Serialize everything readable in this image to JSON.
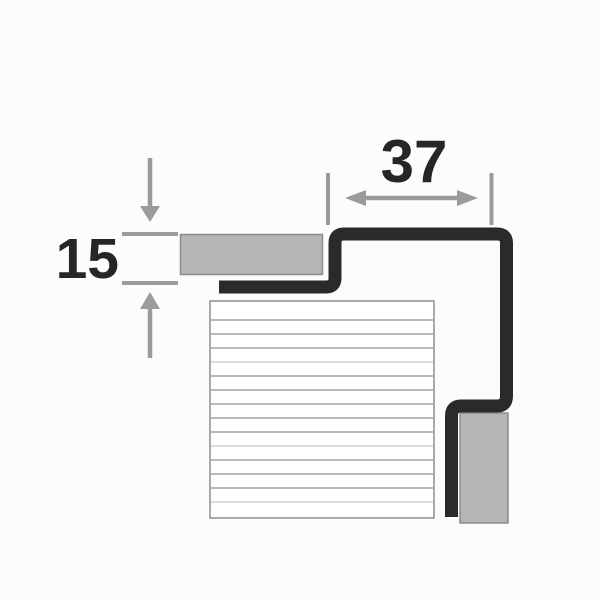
{
  "page": {
    "title": "Step profile cross-section technical diagram",
    "background": "#fcfcfc"
  },
  "diagram": {
    "width_dimension": {
      "value": "37"
    },
    "height_dimension": {
      "value": "15"
    },
    "colors": {
      "profile": "#2b2a29",
      "tile_fill": "#b5b5b5",
      "tile_border": "#8c8c8c",
      "dimension_gray": "#9b9b9b",
      "label_text": "#262626",
      "hatch_fill": "#ffffff",
      "hatch_border": "#7d7d7d",
      "hatch_line": "#8f8f8f",
      "hatch_line_light": "#c6c6c6"
    },
    "hatch": {
      "line_count": 14,
      "first_line_y": 320,
      "line_spacing": 14,
      "x1": 211,
      "x2": 433,
      "light_line_indices": [
        3,
        9,
        13
      ]
    }
  }
}
